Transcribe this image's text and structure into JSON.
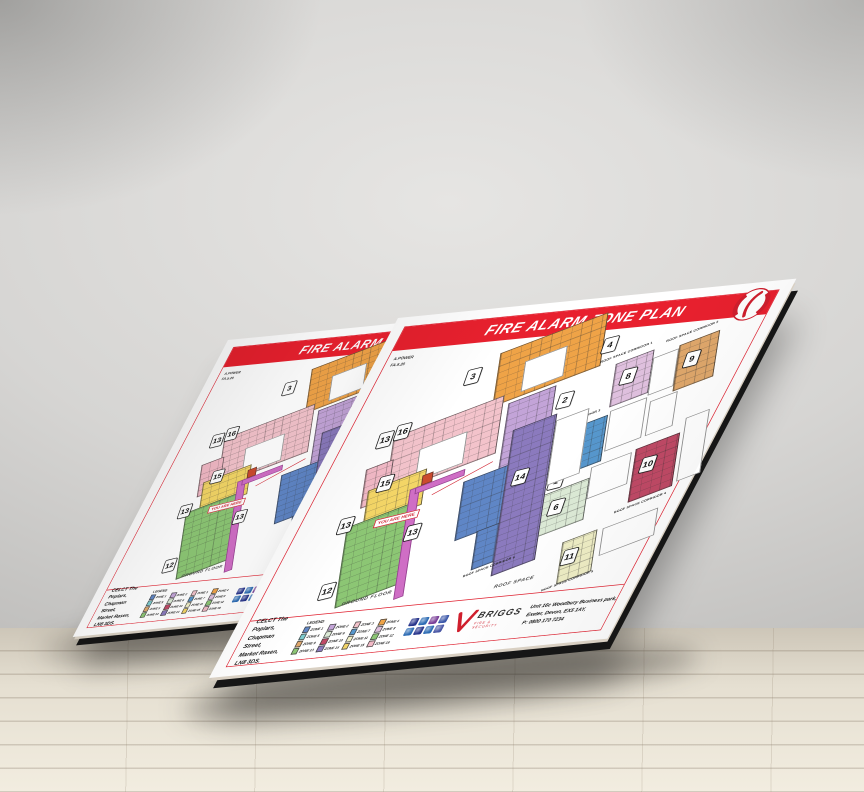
{
  "board": {
    "title": "FIRE ALARM ZONE PLAN",
    "ref": {
      "line1": "A.POWER",
      "line2": "FA.5.20"
    },
    "plan": {
      "ground_floor_label": "GROUND FLOOR",
      "roof_space_label": "ROOF SPACE",
      "you_are_here": "YOU ARE HERE",
      "corridor_labels": [
        "ROOF SPACE CORRIDOR 1",
        "ROOF SPACE CORRIDOR 2",
        "ROOF SPACE CORRIDOR 3",
        "ROOF SPACE CORRIDOR 4",
        "ROOF SPACE CORRIDOR 5",
        "ROOF SPACE CORRIDOR 6"
      ]
    },
    "zones": [
      {
        "n": "1",
        "label": "ZONE 1",
        "color": "#5f86c6"
      },
      {
        "n": "2",
        "label": "ZONE 2",
        "color": "#c3a4d8"
      },
      {
        "n": "3",
        "label": "ZONE 3",
        "color": "#f3c3cb"
      },
      {
        "n": "4",
        "label": "ZONE 4",
        "color": "#efa347"
      },
      {
        "n": "5",
        "label": "ZONE 5",
        "color": "#7ccbce"
      },
      {
        "n": "6",
        "label": "ZONE 6",
        "color": "#dcead6"
      },
      {
        "n": "7",
        "label": "ZONE 7",
        "color": "#5697cd"
      },
      {
        "n": "8",
        "label": "ZONE 8",
        "color": "#dfc0de"
      },
      {
        "n": "9",
        "label": "ZONE 9",
        "color": "#dfa76b"
      },
      {
        "n": "10",
        "label": "ZONE 10",
        "color": "#c04a66"
      },
      {
        "n": "11",
        "label": "ZONE 11",
        "color": "#efeec5"
      },
      {
        "n": "12",
        "label": "ZONE 12",
        "color": "#8cc674"
      },
      {
        "n": "13",
        "label": "ZONE 13",
        "color": "#8cc674"
      },
      {
        "n": "14",
        "label": "ZONE 14",
        "color": "#8b7abe"
      },
      {
        "n": "15",
        "label": "ZONE 15",
        "color": "#f3d566"
      },
      {
        "n": "16",
        "label": "ZONE 16",
        "color": "#f2b9c6"
      }
    ],
    "legend_title": "LEGEND",
    "site_address": [
      "CELCT The Poplars,",
      "Chapman Street,",
      "Market Rasen, LN8 3DS."
    ],
    "company": {
      "name": "BRIGGS",
      "tagline": "FIRE & SECURITY"
    },
    "branch_address": [
      "Unit 16c Woodbury Business park,",
      "Exeter, Devon, EX5 1AY,",
      "P: 0800 170 7234"
    ],
    "colors": {
      "brand_red": "#e8202e",
      "frame_red": "#e0202f",
      "corridor_magenta": "#cf6ec5"
    }
  }
}
